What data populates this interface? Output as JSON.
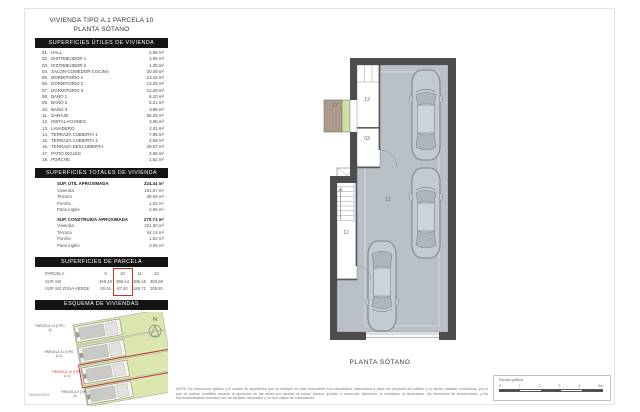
{
  "title": {
    "line1": "VIVIENDA TIPO A.1 PARCELA 10",
    "line2": "PLANTA SÓTANO"
  },
  "sections": {
    "utiles": {
      "header": "SUPERFICIES ÚTILES DE VIVIENDA",
      "rows": [
        {
          "num": "01.",
          "name": "HALL",
          "value": "2.96 m²"
        },
        {
          "num": "02.",
          "name": "DISTRIBUIDOR 1",
          "value": "1.05 m²"
        },
        {
          "num": "03.",
          "name": "DISTRIBUIDOR 2",
          "value": "1.25 m²"
        },
        {
          "num": "04.",
          "name": "SALÓN-COMEDOR-COCINA",
          "value": "30.40 m²"
        },
        {
          "num": "05.",
          "name": "DORMITORIO 1",
          "value": "13.16 m²"
        },
        {
          "num": "06.",
          "name": "DORMITORIO 2",
          "value": "13.25 m²"
        },
        {
          "num": "07.",
          "name": "DORMITORIO 3",
          "value": "12.29 m²"
        },
        {
          "num": "08.",
          "name": "BAÑO 1",
          "value": "6.10 m²"
        },
        {
          "num": "09.",
          "name": "BAÑO 2",
          "value": "5.21 m²"
        },
        {
          "num": "10.",
          "name": "BAÑO 3",
          "value": "3.88 m²"
        },
        {
          "num": "11.",
          "name": "GARAJE",
          "value": "55.25 m²"
        },
        {
          "num": "12.",
          "name": "INSTALACIONES",
          "value": "3.65 m²"
        },
        {
          "num": "13.",
          "name": "LAVADERO",
          "value": "2.41 m²"
        },
        {
          "num": "14.",
          "name": "TERRAZA CUBIERTA 1",
          "value": "7.95 m²"
        },
        {
          "num": "15.",
          "name": "TERRAZA CUBIERTA 2",
          "value": "4.59 m²"
        },
        {
          "num": "16.",
          "name": "TERRAZA DESCUBIERTA",
          "value": "26.07 m²"
        },
        {
          "num": "17.",
          "name": "PATIO INGLÉS",
          "value": "2.66 m²"
        },
        {
          "num": "18.",
          "name": "PORCHE",
          "value": "1.62 m²"
        }
      ]
    },
    "totales": {
      "header": "SUPERFICIES TOTALES DE VIVIENDA",
      "groups": [
        {
          "label": "SUP. ÚTIL APROXIMADA",
          "value": "224.44 m²",
          "rows": [
            {
              "name": "Vivienda",
              "value": "181.57 m²"
            },
            {
              "name": "Terraza",
              "value": "38.59 m²"
            },
            {
              "name": "Porche",
              "value": "1.62 m²"
            },
            {
              "name": "Patio inglés",
              "value": "2.66 m²"
            }
          ]
        },
        {
          "label": "SUP. CONSTRUIDA APROXIMADA",
          "value": "270.71 m²",
          "rows": [
            {
              "name": "Vivienda",
              "value": "221.90 m²"
            },
            {
              "name": "Terraza",
              "value": "44.14 m²"
            },
            {
              "name": "Porche",
              "value": "1.62 m²"
            },
            {
              "name": "Patio inglés",
              "value": "3.05 m²"
            }
          ]
        }
      ]
    },
    "parcela": {
      "header": "SUPERFICIES DE PARCELA",
      "rows": [
        {
          "label": "PARCELA",
          "v1": "9",
          "v2": "10",
          "v3": "11",
          "v4": "12"
        },
        {
          "label": "SUP. M2",
          "v1": "459.40",
          "v2": "396.14",
          "v3": "396.16",
          "v4": "463.96"
        },
        {
          "label": "SUP. M2 ZONA VERDE",
          "v1": "29.24",
          "v2": "87.40",
          "v3": "185.71",
          "v4": "208.81"
        }
      ],
      "highlighted_column": "10"
    },
    "esquema": {
      "header": "ESQUEMA DE VIVIENDAS",
      "north_label": "N",
      "parcels": [
        {
          "label": "PARCELA 12 (TIPO A)"
        },
        {
          "label": "PARCELA 11 (TIPO A.2)"
        },
        {
          "label": "PARCELA 10 (TIPO A.1)",
          "highlight": true
        },
        {
          "label": "PARCELA 9 (TIPO A)"
        }
      ]
    }
  },
  "plan": {
    "caption": "PLANTA SÓTANO",
    "room_labels": {
      "patio_ingles": "17",
      "lavadero": "13",
      "distribuidor": "03",
      "garaje": "11",
      "instalaciones": "12"
    }
  },
  "footer": {
    "date": "06/03/2024",
    "disclaimer": "NOTA: La información gráfica y el cuadro de superficies que se incluyen en este documento son orientativos, elaborados a partir del proyecto del edificio y no tienen carácter contractual, por lo que se podrán modificar durante la ejecución de las obras por causas de índole técnico, jurídico o comercial. Asimismo, el mobiliario, la decoración, los elementos de ambientación y los electrodomésticos incluidos son de carácter decorativo y no son objeto de contratación.",
    "scale_label": "Escala gráfica",
    "scale_ticks": [
      {
        "t": "0"
      },
      {
        "t": "1"
      },
      {
        "t": "2"
      },
      {
        "t": "3"
      },
      {
        "t": "4"
      },
      {
        "t": "5m"
      }
    ]
  },
  "colors": {
    "header_bar": "#141414",
    "accent_red": "#c0392b",
    "wall": "#4d4d4d",
    "garage_floor": "#b9c0c7",
    "parcel_green": "#dbe7ad",
    "patio_brown": "#b2a08f",
    "patio_green": "#cfe0a5"
  }
}
